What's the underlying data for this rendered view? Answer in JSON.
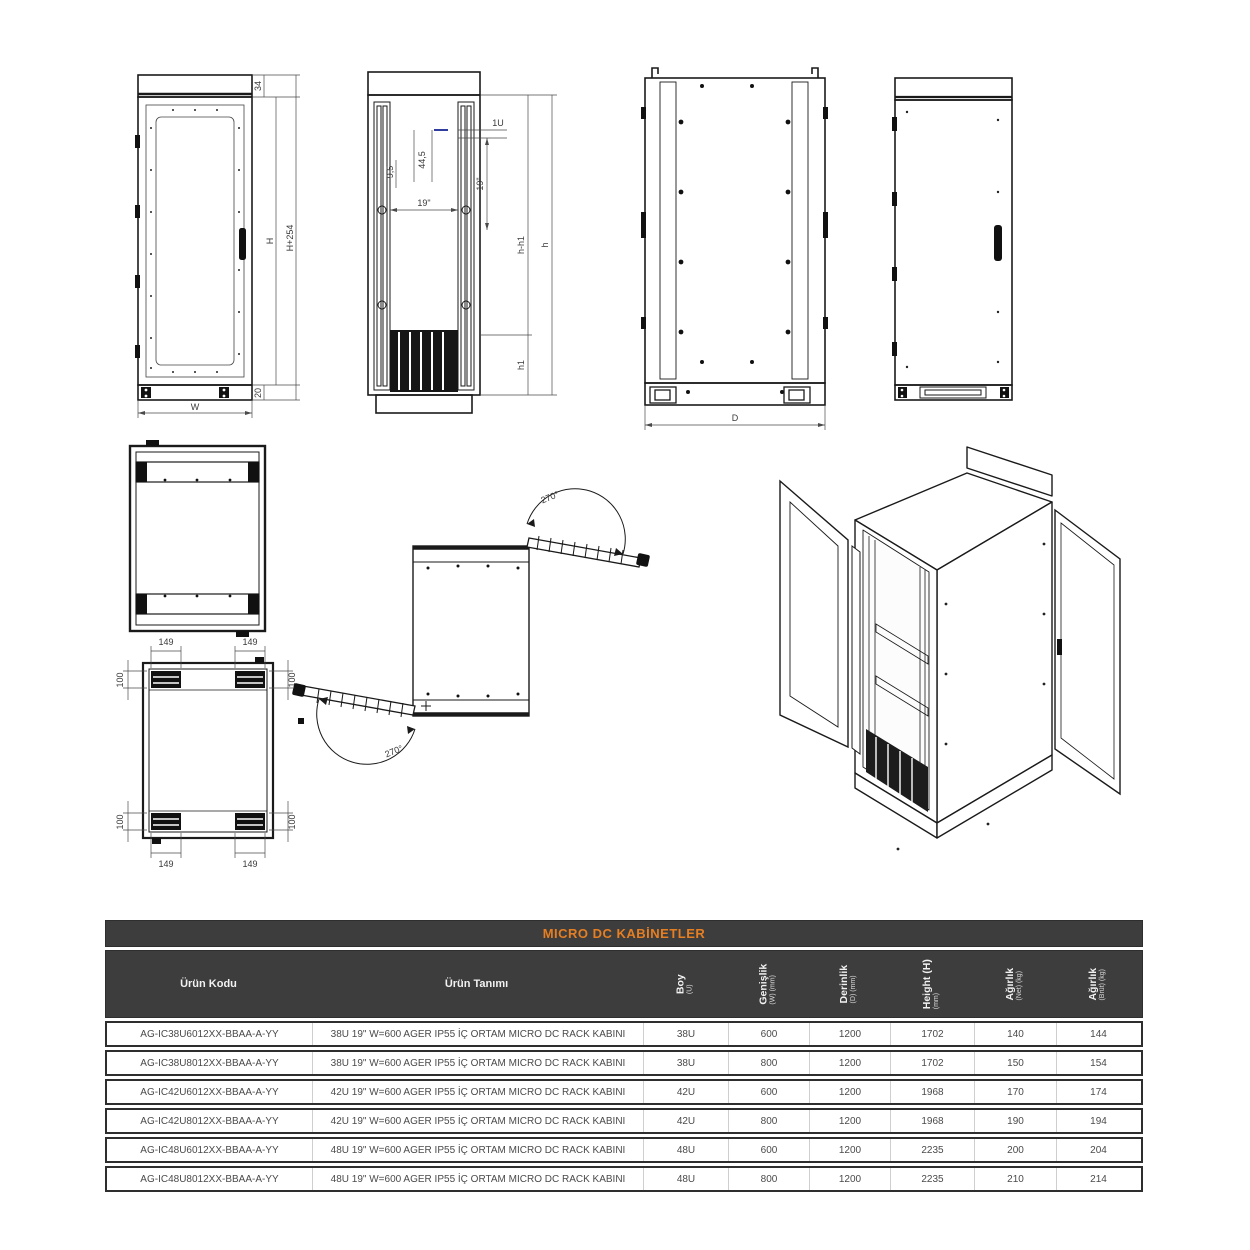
{
  "colors": {
    "line": "#1a1a1a",
    "dim_line": "#4a4a4a",
    "accent_blue": "#2e3d9e",
    "title_orange": "#e67e22",
    "header_bg": "#3d3d3d",
    "row_border": "#2e2e2e",
    "row_text": "#4a4a4a"
  },
  "drawings": {
    "front": {
      "d34": "34",
      "dH": "H",
      "dH254": "H+254",
      "d20": "20",
      "dW": "W"
    },
    "rack": {
      "d1u": "1U",
      "d445": "44,5",
      "d19v": "19\"",
      "d95": "9,5",
      "d19h": "19\"",
      "dhh1": "h-h1",
      "dh": "h",
      "dh1": "h1"
    },
    "side": {
      "dD": "D"
    },
    "bottom": {
      "d149": "149",
      "d100": "100"
    },
    "swing": {
      "top": "270°",
      "bottom": "270°"
    }
  },
  "table": {
    "title": "MICRO DC KABİNETLER",
    "columns": [
      {
        "label": "Ürün Kodu",
        "sub": ""
      },
      {
        "label": "Ürün Tanımı",
        "sub": ""
      },
      {
        "label": "Boy",
        "sub": "(U)"
      },
      {
        "label": "Genişlik",
        "sub": "(W) (mm)"
      },
      {
        "label": "Derinlik",
        "sub": "(D) (mm)"
      },
      {
        "label": "Height (H)",
        "sub": "(mm)"
      },
      {
        "label": "Ağırlık",
        "sub": "(Net) (kg)"
      },
      {
        "label": "Ağırlık",
        "sub": "(Brüt) (kg)"
      }
    ],
    "rows": [
      [
        "AG-IC38U6012XX-BBAA-A-YY",
        "38U 19\" W=600 AGER IP55 İÇ ORTAM MICRO DC RACK KABINI",
        "38U",
        "600",
        "1200",
        "1702",
        "140",
        "144"
      ],
      [
        "AG-IC38U8012XX-BBAA-A-YY",
        "38U 19\" W=600 AGER IP55 İÇ ORTAM MICRO DC RACK KABINI",
        "38U",
        "800",
        "1200",
        "1702",
        "150",
        "154"
      ],
      [
        "AG-IC42U6012XX-BBAA-A-YY",
        "42U 19\" W=600 AGER IP55 İÇ ORTAM MICRO DC RACK KABINI",
        "42U",
        "600",
        "1200",
        "1968",
        "170",
        "174"
      ],
      [
        "AG-IC42U8012XX-BBAA-A-YY",
        "42U 19\" W=600 AGER IP55 İÇ ORTAM MICRO DC RACK KABINI",
        "42U",
        "800",
        "1200",
        "1968",
        "190",
        "194"
      ],
      [
        "AG-IC48U6012XX-BBAA-A-YY",
        "48U 19\" W=600 AGER IP55 İÇ ORTAM MICRO DC RACK KABINI",
        "48U",
        "600",
        "1200",
        "2235",
        "200",
        "204"
      ],
      [
        "AG-IC48U8012XX-BBAA-A-YY",
        "48U 19\" W=600 AGER IP55 İÇ ORTAM MICRO DC RACK KABINI",
        "48U",
        "800",
        "1200",
        "2235",
        "210",
        "214"
      ]
    ]
  }
}
